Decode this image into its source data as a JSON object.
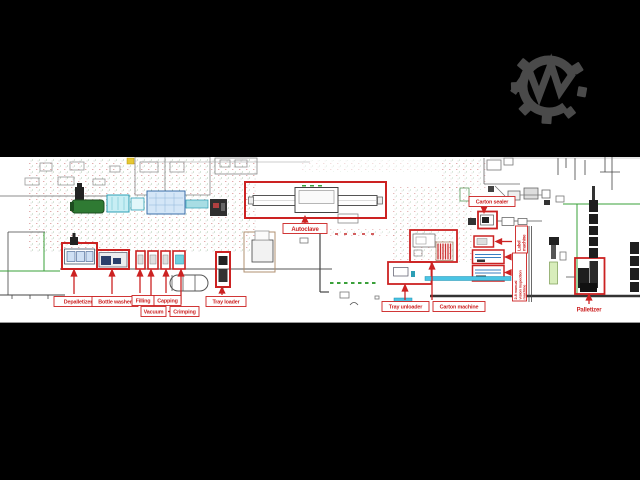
{
  "window": {
    "description": "Letterboxed CAD floor plan of a pharmaceutical bottling / packing line with red callout labels",
    "background_color": "#000000"
  },
  "logo": {
    "icon": "gear-m-logo",
    "color": "#4a4a4a"
  },
  "plan": {
    "accent_color": "#cc2222",
    "conveyor_color": "#4ac4e4",
    "wall_color": "#555555",
    "green_line_color": "#3aa03a",
    "labels": {
      "depalletizer": "Depalletizer",
      "bottle_washer": "Bottle washer",
      "filling": "Filling",
      "vacuum": "Vacuum",
      "capping": "Capping",
      "crimping": "Crimping",
      "tray_loader": "Tray loader",
      "autoclave": "Autoclave",
      "carton_sealer": "Carton sealer",
      "tray_unloader": "Tray unloader",
      "carton_machine": "Carton machine",
      "palletizer": "Palletizer",
      "label_machine_lines": {
        "0": "Label",
        "1": "machine"
      },
      "inspection_lines": {
        "0": "2-8 manual",
        "1": "vision inspection",
        "2": "machine"
      }
    }
  }
}
